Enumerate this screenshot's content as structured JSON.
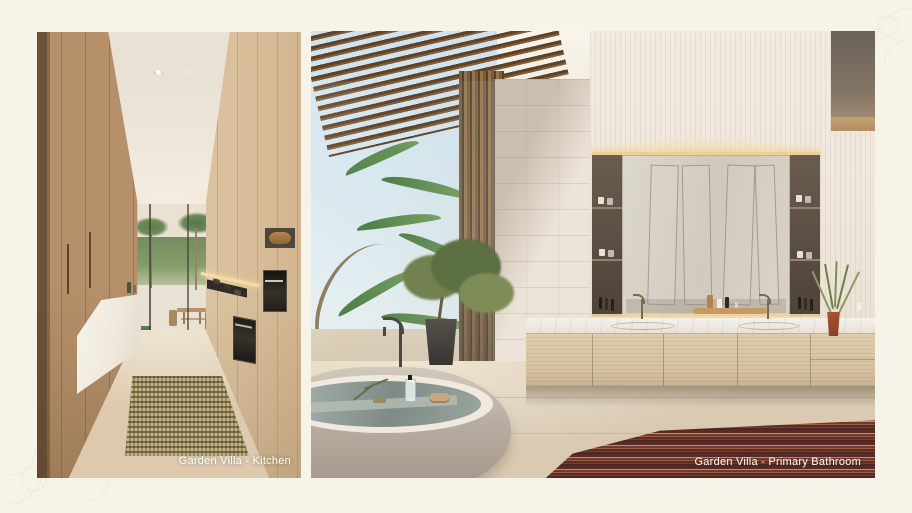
{
  "page": {
    "background_color": "#f6f4e8"
  },
  "panels": [
    {
      "name": "kitchen",
      "caption": "Garden Villa - Kitchen"
    },
    {
      "name": "primary_bathroom",
      "caption": "Garden Villa - Primary Bathroom"
    }
  ],
  "colors": {
    "caption_text": "#ffffff",
    "kitchen_wood": "#b6906a",
    "bathroom_tile": "#ece4d8",
    "mirror_glow": "#f0cf96",
    "bathroom_rug": "#6e3a30",
    "kitchen_rug": "#b8a878"
  }
}
